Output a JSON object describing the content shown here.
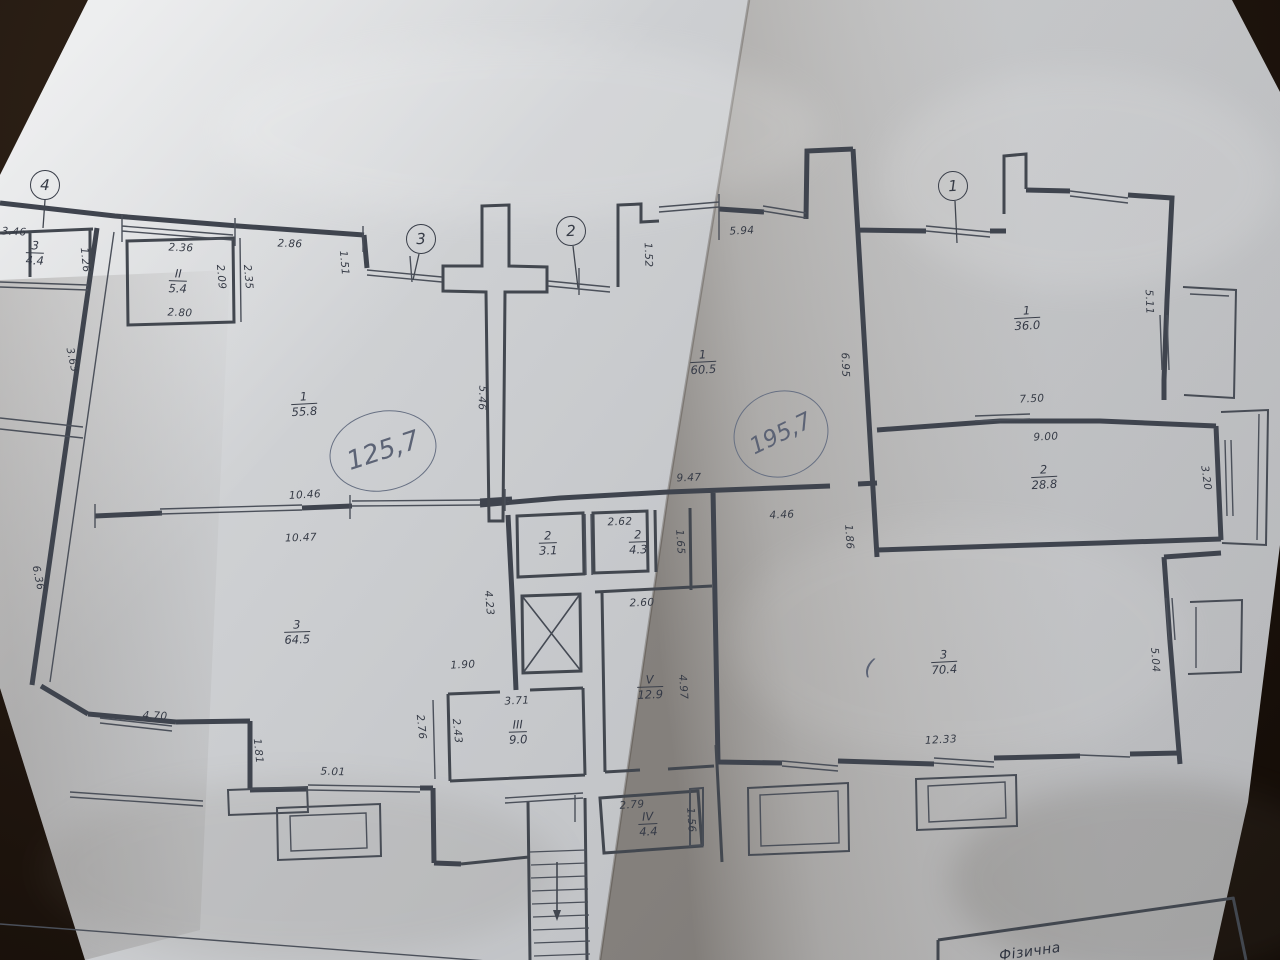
{
  "document_type": "apartment-floor-plan-photo",
  "colors": {
    "background_dark": "#241911",
    "paper_light": "#d7d9db",
    "paper_shaded": "#8d8a84",
    "ink_line": "#3f444e",
    "pen_handwriting": "#5c6375"
  },
  "axis_markers": [
    {
      "label": "4",
      "x": 45,
      "y": 185,
      "rot": 2
    },
    {
      "label": "3",
      "x": 421,
      "y": 239,
      "rot": -2
    },
    {
      "label": "2",
      "x": 571,
      "y": 231,
      "rot": -2
    },
    {
      "label": "1",
      "x": 953,
      "y": 186,
      "rot": -3
    }
  ],
  "rooms": [
    {
      "num": "3",
      "area": "4.4",
      "x": 35,
      "y": 253,
      "rot": 2
    },
    {
      "num": "II",
      "area": "5.4",
      "x": 178,
      "y": 281,
      "rot": 2
    },
    {
      "num": "1",
      "area": "55.8",
      "x": 304,
      "y": 404,
      "rot": -3
    },
    {
      "num": "1",
      "area": "60.5",
      "x": 703,
      "y": 362,
      "rot": -3
    },
    {
      "num": "1",
      "area": "36.0",
      "x": 1027,
      "y": 318,
      "rot": -3
    },
    {
      "num": "2",
      "area": "28.8",
      "x": 1044,
      "y": 477,
      "rot": -3
    },
    {
      "num": "2",
      "area": "3.1",
      "x": 548,
      "y": 543,
      "rot": -2
    },
    {
      "num": "2",
      "area": "4.3",
      "x": 638,
      "y": 542,
      "rot": -2
    },
    {
      "num": "3",
      "area": "64.5",
      "x": 297,
      "y": 632,
      "rot": -2
    },
    {
      "num": "3",
      "area": "70.4",
      "x": 944,
      "y": 662,
      "rot": -3
    },
    {
      "num": "V",
      "area": "12.9",
      "x": 650,
      "y": 687,
      "rot": -2
    },
    {
      "num": "III",
      "area": "9.0",
      "x": 518,
      "y": 732,
      "rot": -2
    },
    {
      "num": "IV",
      "area": "4.4",
      "x": 648,
      "y": 824,
      "rot": -3
    }
  ],
  "dimensions": [
    {
      "text": "3.46",
      "x": 14,
      "y": 232,
      "rot": 3
    },
    {
      "text": "1.26",
      "x": 85,
      "y": 260,
      "rot": 84
    },
    {
      "text": "2.36",
      "x": 181,
      "y": 248,
      "rot": 2
    },
    {
      "text": "2.86",
      "x": 290,
      "y": 244,
      "rot": 2
    },
    {
      "text": "1.51",
      "x": 344,
      "y": 263,
      "rot": 85
    },
    {
      "text": "2.09",
      "x": 221,
      "y": 277,
      "rot": 85
    },
    {
      "text": "2.35",
      "x": 248,
      "y": 277,
      "rot": 85
    },
    {
      "text": "2.80",
      "x": 180,
      "y": 313,
      "rot": 2
    },
    {
      "text": "3.63",
      "x": 72,
      "y": 360,
      "rot": 78
    },
    {
      "text": "5.46",
      "x": 482,
      "y": 398,
      "rot": 92
    },
    {
      "text": "1.52",
      "x": 648,
      "y": 255,
      "rot": 88
    },
    {
      "text": "5.94",
      "x": 742,
      "y": 231,
      "rot": -3
    },
    {
      "text": "5.11",
      "x": 1149,
      "y": 302,
      "rot": 88
    },
    {
      "text": "6.95",
      "x": 845,
      "y": 365,
      "rot": 88
    },
    {
      "text": "7.50",
      "x": 1032,
      "y": 399,
      "rot": -3
    },
    {
      "text": "9.00",
      "x": 1046,
      "y": 437,
      "rot": -3
    },
    {
      "text": "3.20",
      "x": 1206,
      "y": 478,
      "rot": 82
    },
    {
      "text": "10.46",
      "x": 305,
      "y": 495,
      "rot": -3
    },
    {
      "text": "10.47",
      "x": 301,
      "y": 538,
      "rot": -2
    },
    {
      "text": "9.47",
      "x": 689,
      "y": 478,
      "rot": -2
    },
    {
      "text": "2.62",
      "x": 620,
      "y": 522,
      "rot": -2
    },
    {
      "text": "1.65",
      "x": 680,
      "y": 542,
      "rot": 86
    },
    {
      "text": "4.46",
      "x": 782,
      "y": 515,
      "rot": -3
    },
    {
      "text": "1.86",
      "x": 849,
      "y": 537,
      "rot": 86
    },
    {
      "text": "6.36",
      "x": 38,
      "y": 578,
      "rot": 78
    },
    {
      "text": "4.23",
      "x": 489,
      "y": 603,
      "rot": 85
    },
    {
      "text": "2.60",
      "x": 642,
      "y": 603,
      "rot": -2
    },
    {
      "text": "1.90",
      "x": 463,
      "y": 665,
      "rot": -3
    },
    {
      "text": "4.97",
      "x": 683,
      "y": 687,
      "rot": 86
    },
    {
      "text": "5.04",
      "x": 1155,
      "y": 660,
      "rot": 86
    },
    {
      "text": "12.33",
      "x": 941,
      "y": 740,
      "rot": -3
    },
    {
      "text": "3.71",
      "x": 517,
      "y": 701,
      "rot": -3
    },
    {
      "text": "2.76",
      "x": 421,
      "y": 727,
      "rot": 84
    },
    {
      "text": "2.43",
      "x": 457,
      "y": 731,
      "rot": 84
    },
    {
      "text": "4.70",
      "x": 155,
      "y": 716,
      "rot": 3
    },
    {
      "text": "1.81",
      "x": 258,
      "y": 751,
      "rot": 84
    },
    {
      "text": "5.01",
      "x": 333,
      "y": 772,
      "rot": 2
    },
    {
      "text": "2.79",
      "x": 632,
      "y": 805,
      "rot": -4
    },
    {
      "text": "1.56",
      "x": 691,
      "y": 820,
      "rot": 86
    }
  ],
  "handwritten": [
    {
      "text": "125,7",
      "x": 383,
      "y": 451,
      "rot": -12,
      "w": 106,
      "h": 78,
      "font": 26
    },
    {
      "text": "195,7",
      "x": 781,
      "y": 434,
      "rot": -20,
      "w": 94,
      "h": 84,
      "font": 23
    }
  ],
  "pen_marks": [
    {
      "text": "(",
      "x": 869,
      "y": 668,
      "rot": 8,
      "font": 22
    }
  ],
  "title_block": {
    "text": "Фізична"
  }
}
